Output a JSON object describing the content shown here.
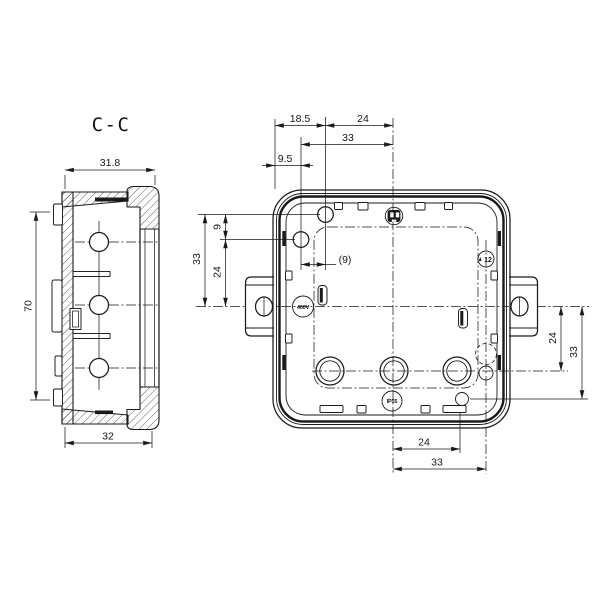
{
  "section_view": {
    "label": "C-C",
    "dim_depth": "31.8",
    "dim_height": "70",
    "dim_width": "32"
  },
  "front_view": {
    "dim_top_offset_small": "9.5",
    "dim_top_offset": "18.5",
    "dim_top_to_center": "24",
    "dim_top_to_center2": "33",
    "dim_ref": "(9)",
    "dim_left_gap": "9",
    "dim_left_to_center": "24",
    "dim_left_to_center2": "33",
    "dim_right_to_hole": "24",
    "dim_right_to_hole2": "33",
    "dim_bottom_to_hole": "24",
    "dim_bottom_to_hole2": "33",
    "marking_voltage": "400V",
    "marking_ip": "IP55",
    "marking_date_wheel": "12"
  }
}
